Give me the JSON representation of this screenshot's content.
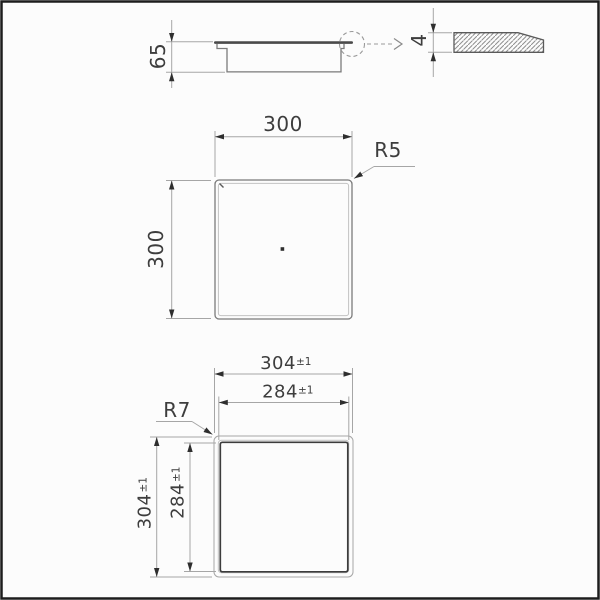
{
  "drawing": {
    "type": "technical-installation-drawing",
    "side_view": {
      "height_dim": "65"
    },
    "detail_view": {
      "thickness_dim": "4"
    },
    "plan_view": {
      "width_dim": "300",
      "height_dim": "300",
      "corner_radius_label": "R5"
    },
    "cutout_view": {
      "outer_dim": "304",
      "outer_tol": "±1",
      "inner_dim": "284",
      "inner_tol": "±1",
      "corner_radius_label": "R7"
    },
    "colors": {
      "background": "#fcfcfc",
      "frame": "#1d1d1d",
      "object_line": "#7a7a7a",
      "bold_line": "#3c3c3c",
      "dimension_line": "#a6a6a6",
      "arrow": "#2e2e2e",
      "text": "#3d3d3d"
    }
  }
}
